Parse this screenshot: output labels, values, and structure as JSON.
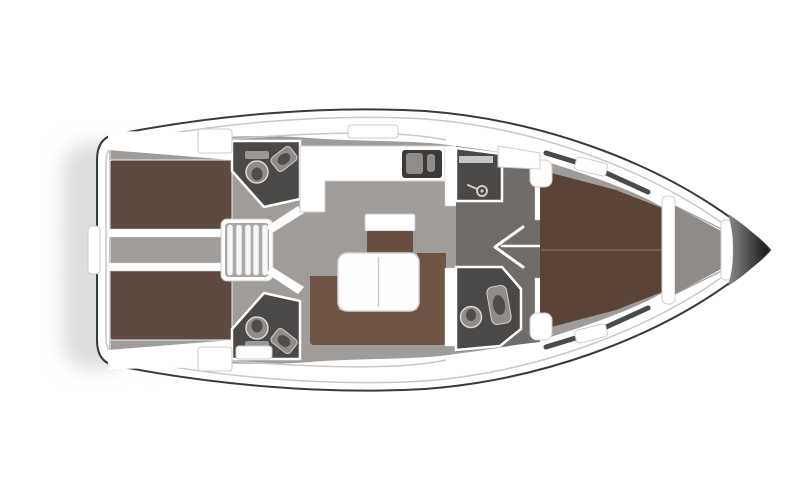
{
  "diagram": {
    "type": "yacht-floor-plan",
    "description": "Top-down interior layout plan of a sailing yacht, bow pointing right"
  },
  "colors": {
    "shadow": "#dedede",
    "hullOutline": "#3a3a3a",
    "hullFill": "#ffffff",
    "toeRail": "#c8c8c8",
    "deckWhite": "#ffffff",
    "wallWhite": "#ffffff",
    "floorGray": "#a09c99",
    "corridorGray": "#a8a5a2",
    "vestibuleGray": "#6f6c69",
    "headDark": "#4b4947",
    "bedAft": "#5e4a40",
    "bedFwd": "#5a4437",
    "settee": "#6e5546",
    "bench": "#684f41",
    "tableFill": "#fefefe",
    "tableLine": "#cccccc",
    "sinkInset": "#3b3a39",
    "fixtureMid": "#8f8c89",
    "fixtureLight": "#9b9894",
    "fixtureDark": "#504d4a",
    "windowDark": "#4a4a4a",
    "bowDark1": "#8a8a8a",
    "bowDark2": "#161616",
    "forepeakGray": "#8e8b89",
    "hatchStroke": "#cccccc"
  },
  "areas": [
    {
      "name": "hull",
      "label": "hull-outline"
    },
    {
      "name": "transom",
      "label": "stern-transom-swim-platform"
    },
    {
      "name": "aft-cabin-top",
      "label": "aft-double-cabin-port"
    },
    {
      "name": "aft-cabin-bottom",
      "label": "aft-double-cabin-starboard"
    },
    {
      "name": "aft-corridor",
      "label": "aft-corridor"
    },
    {
      "name": "companionway-steps",
      "label": "companionway-steps"
    },
    {
      "name": "aft-head-top",
      "label": "aft-head-wc-port"
    },
    {
      "name": "aft-head-bottom",
      "label": "aft-head-wc-starboard"
    },
    {
      "name": "galley",
      "label": "l-shaped-galley-with-double-sink"
    },
    {
      "name": "chart-seat",
      "label": "side-seat"
    },
    {
      "name": "salon-table",
      "label": "salon-table"
    },
    {
      "name": "salon-settee",
      "label": "u-shaped-settee"
    },
    {
      "name": "fwd-vestibule",
      "label": "forward-vestibule"
    },
    {
      "name": "fwd-shower",
      "label": "forward-shower-compartment"
    },
    {
      "name": "fwd-head",
      "label": "forward-head-wc"
    },
    {
      "name": "fwd-cabin-door",
      "label": "forward-cabin-door-swing"
    },
    {
      "name": "fwd-cabin",
      "label": "forward-owner-cabin-v-berth"
    },
    {
      "name": "forepeak",
      "label": "forepeak-bulkheads"
    },
    {
      "name": "bow",
      "label": "bow-anchor-locker"
    }
  ]
}
